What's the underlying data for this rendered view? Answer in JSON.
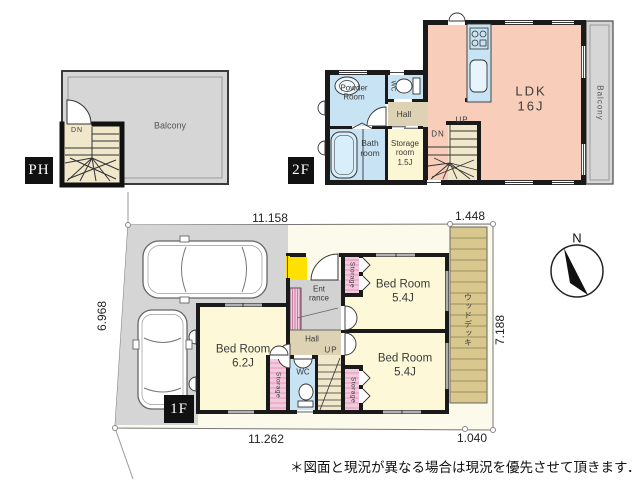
{
  "floors": {
    "ph": {
      "tag": "PH",
      "balcony": "Balcony",
      "stairs_dn": "DN"
    },
    "f2": {
      "tag": "2F",
      "ldk": "LDK\n16J",
      "powder_room": "Powder\nRoom",
      "wc": "WC",
      "hall": "Hall",
      "bath_room": "Bath\nroom",
      "storage_room": "Storage\nroom\n1.5J",
      "stairs_up": "UP",
      "stairs_dn": "DN",
      "balcony": "Balcony"
    },
    "f1": {
      "tag": "1F",
      "bedroom_left": "Bed Room\n6.2J",
      "bedroom_top": "Bed Room\n5.4J",
      "bedroom_bottom": "Bed Room\n5.4J",
      "entrance": "Ent\nrance",
      "hall": "Hall",
      "wc": "WC",
      "stairs_up": "UP",
      "storage": "Storage",
      "wood_deck": "ウッドデッキ"
    }
  },
  "dimensions": {
    "top": "11.158",
    "top_right": "1.448",
    "left": "6.968",
    "right": "7.188",
    "bottom": "11.262",
    "bottom_right": "1.040"
  },
  "compass_n": "N",
  "note": "＊図面と現況が異なる場合は現況を優先させて頂きます．",
  "colors": {
    "wall": "#1a1a1a",
    "room_yellow": "#fcf8d8",
    "ldk_salmon": "#f8cebb",
    "water_blue": "#c8e4f4",
    "hall_tan": "#ddd2b4",
    "stair_tan": "#f1e8cb",
    "storage_pink": "#f3c9dd",
    "balcony_gray": "#d6d6d6",
    "porch_yellow": "#ffe100",
    "deck_tan": "#d8c88e",
    "lot_cream": "#fcfaeb"
  }
}
